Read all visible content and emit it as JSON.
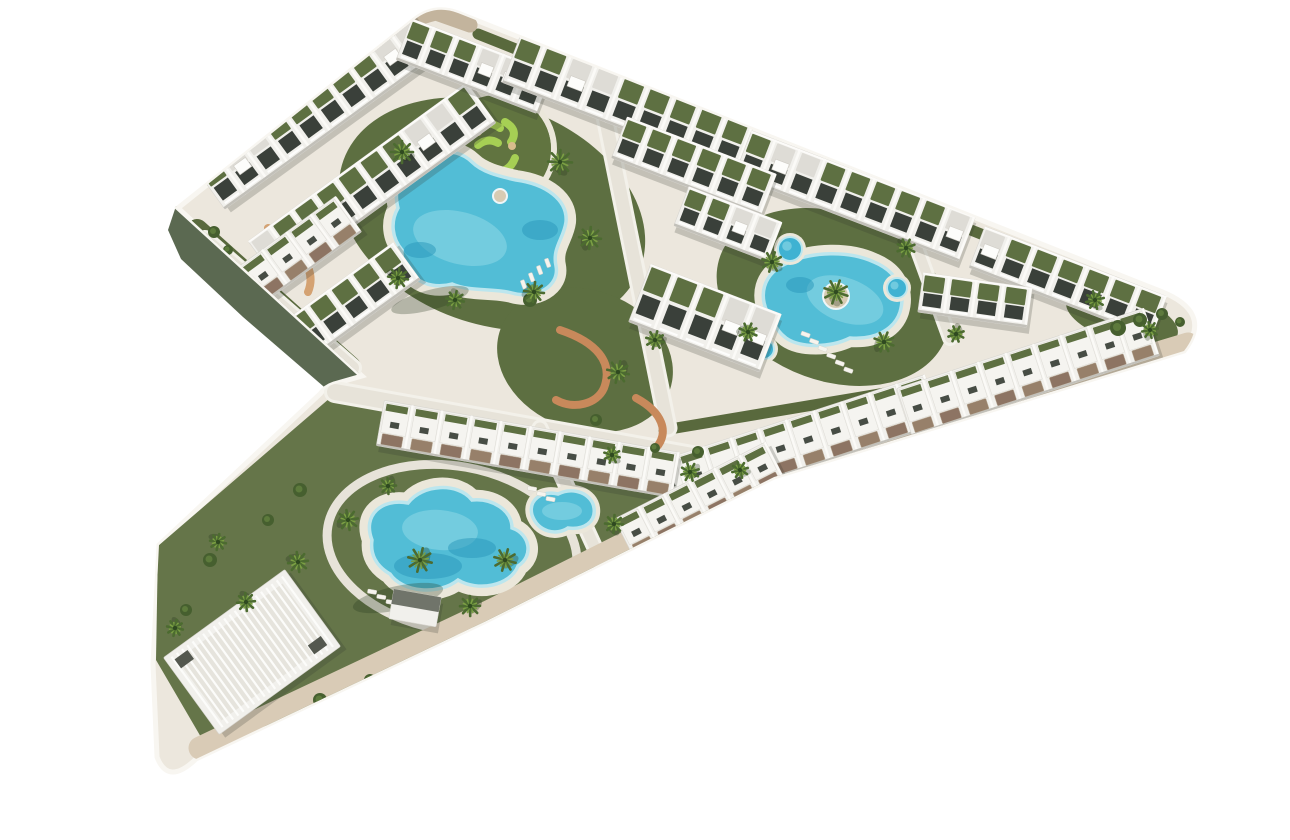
{
  "meta": {
    "title": "Aerial 3D architectural rendering of a chevron-shaped residential resort complex with white apartment rows, green roof gardens, three freeform swimming pools, spa circles and palm trees on a white background"
  },
  "palette": {
    "background": "#ffffff",
    "platform": "#ece7dd",
    "platform_rim": "#f8f6f1",
    "platform_side_dark": "#5b6951",
    "road_beige": "#d9cbb6",
    "road_tan": "#c3b49d",
    "road_light": "#e7e3d9",
    "road_casing": "#f3f1ea",
    "lawn": "#5d6f41",
    "lawn_light": "#657549",
    "lawn_edge": "#59693d",
    "minigolf_green": "#617440",
    "minigolf_lime": "#a6cf54",
    "court_green": "#3f5c31",
    "court_line": "#c9d2bf",
    "pool_water": "#52bdd6",
    "pool_light": "#86d4e4",
    "pool_deep": "#2796ba",
    "pool_edge": "#bce6ee",
    "pool_deck": "#ebe7da",
    "spa_water": "#3fb2d2",
    "building_white": "#f1f0ec",
    "building_shadow": "#c2c0b9",
    "window_dark": "#3a403a",
    "roof_green": "#5e7042",
    "patio_brown": "#97806a",
    "patio_brown2": "#8d7463",
    "path_terracotta": "#c8895b",
    "path_sand": "#d4a272",
    "palm_dark": "#4c6b30",
    "palm_light": "#7ba043",
    "bush": "#465f2f",
    "island_sand": "#d7cbb3"
  },
  "scene": {
    "platform_path": "M 178 208 L 414 20 Q 434 4 458 13 L 1160 291 Q 1214 312 1184 351 L 774 477 L 486 621 L 196 759 Q 168 786 157 757 L 153 664 L 159 545 L 320 394 Q 325 387 334 384 L 362 376 Z",
    "side_path": "M 176 206 L 362 374 L 345 405 L 243 317 L 181 259 L 168 230 Z",
    "tan_band_path": "M 362 52 Q 398 22 436 13 L 470 25",
    "beige_band_path": "M 1188 344 L 776 468 L 488 612 L 200 748",
    "edge_lawns": [
      [
        197,
        230,
        350,
        367,
        22
      ],
      [
        240,
        178,
        414,
        36,
        13
      ],
      [
        478,
        34,
        1152,
        302,
        11
      ],
      [
        664,
        430,
        1178,
        344,
        11
      ],
      [
        354,
        390,
        768,
        468,
        10
      ]
    ],
    "lawn_ellipses": [
      [
        492,
        214,
        158,
        110,
        20
      ],
      [
        833,
        297,
        120,
        84,
        20
      ],
      [
        1122,
        318,
        58,
        24,
        17
      ],
      [
        585,
        360,
        90,
        70,
        20
      ]
    ],
    "lawn_polygon": "M 330 398 L 700 462 L 770 476 L 560 638 L 205 744 L 156 660 L 158 546 Z",
    "roads": [
      [
        205,
        240,
        352,
        368,
        14
      ],
      [
        335,
        392,
        815,
        478,
        16
      ],
      [
        601,
        97,
        668,
        428,
        13
      ],
      [
        893,
        182,
        950,
        338,
        10
      ],
      [
        540,
        428,
        612,
        585,
        11
      ],
      [
        228,
        182,
        420,
        29,
        11
      ]
    ],
    "road_ring": [
      452,
      548,
      126,
      82,
      10,
      9
    ],
    "terracotta_paths": [
      "M 560 330 C 596 342 614 362 604 388 C 597 404 574 410 556 400",
      "M 636 398 C 662 412 670 432 656 448",
      "M 268 228 C 298 248 318 268 308 292"
    ],
    "minigolf": {
      "cx": 497,
      "cy": 149,
      "r": 54,
      "ring_r": 57,
      "squiggles": [
        "M 468 128 q 18 -10 32 0",
        "M 505 122 q 14 8 6 20",
        "M 515 158 q -6 16 -24 14",
        "M 482 170 q -16 -2 -18 -18",
        "M 478 145 q 10 -8 20 -2"
      ],
      "sand": [
        [
          478,
          132
        ],
        [
          512,
          146
        ],
        [
          489,
          166
        ]
      ]
    },
    "court": {
      "cx": 436,
      "cy": 206,
      "w": 82,
      "h": 48,
      "rot": 24
    },
    "pools": [
      {
        "name": "pool-lagoon",
        "deck": 20,
        "d": "M 405 175 C 420 148 455 145 472 162 C 482 172 498 176 516 180 C 546 184 568 200 566 222 C 564 238 552 248 556 266 C 560 286 536 300 512 293 C 494 288 470 292 452 284 C 424 292 400 272 402 250 C 392 238 390 222 398 208 C 394 192 398 184 405 175 Z",
        "light": [
          460,
          238,
          48,
          26,
          15
        ],
        "deep": [
          [
            540,
            230,
            18,
            10
          ],
          [
            420,
            250,
            16,
            8
          ]
        ]
      },
      {
        "name": "pool-oval-island",
        "deck": 18,
        "d": "M 772 320 C 756 298 762 272 790 262 C 812 252 848 250 874 262 C 898 272 906 292 900 312 C 894 330 874 340 850 338 C 830 348 800 348 786 338 C 778 332 776 327 772 320 Z",
        "light": [
          845,
          300,
          40,
          22,
          20
        ],
        "deep": [
          [
            800,
            285,
            14,
            8
          ]
        ]
      },
      {
        "name": "pool-lower",
        "deck": 20,
        "d": "M 372 540 C 362 515 382 498 408 503 C 422 484 458 482 472 500 C 492 498 512 510 512 528 C 530 534 534 556 518 566 C 510 586 478 592 458 580 C 438 596 402 592 390 574 C 376 566 370 554 372 540 Z",
        "light": [
          440,
          530,
          38,
          20,
          5
        ],
        "deep": [
          [
            428,
            566,
            34,
            13
          ],
          [
            472,
            548,
            24,
            10
          ]
        ]
      },
      {
        "name": "pool-kidney",
        "deck": 12,
        "d": "M 532 515 C 528 500 542 490 558 494 C 574 486 592 494 594 508 C 596 522 584 530 568 528 C 556 536 538 532 532 515 Z",
        "light": [
          562,
          511,
          20,
          9,
          0
        ],
        "deep": []
      }
    ],
    "islands": [
      [
        836,
        296,
        13
      ],
      [
        500,
        196,
        7
      ]
    ],
    "spas": [
      [
        790,
        249,
        12
      ],
      [
        897,
        288,
        10
      ],
      [
        764,
        349,
        10
      ]
    ],
    "pool_shadows": [
      [
        398,
        598,
        46,
        12,
        -12
      ],
      [
        430,
        300,
        40,
        10,
        -15
      ]
    ],
    "loungers": [
      {
        "x": 802,
        "y": 331,
        "rot": 20,
        "n": 6,
        "dx": 10.5,
        "dy": 3.8
      },
      {
        "x": 548,
        "y": 258,
        "rot": 70,
        "n": 4,
        "dx": 4,
        "dy": 10
      },
      {
        "x": 368,
        "y": 589,
        "rot": 10,
        "n": 4,
        "dx": 10,
        "dy": 3.5
      },
      {
        "x": 528,
        "y": 486,
        "rot": 10,
        "n": 3,
        "dx": 10,
        "dy": 3.5
      }
    ],
    "blocks": [
      [
        318,
        112,
        265,
        48,
        -36,
        "row"
      ],
      [
        372,
        182,
        270,
        50,
        -36,
        "row"
      ],
      [
        342,
        308,
        160,
        46,
        -36,
        "row"
      ],
      [
        288,
        258,
        150,
        44,
        -36,
        "town"
      ],
      [
        474,
        66,
        150,
        44,
        21,
        "row"
      ],
      [
        628,
        104,
        250,
        50,
        21,
        "row"
      ],
      [
        855,
        196,
        240,
        48,
        21,
        "row"
      ],
      [
        1068,
        282,
        195,
        44,
        21,
        "row"
      ],
      [
        694,
        166,
        160,
        44,
        21,
        "row"
      ],
      [
        975,
        300,
        110,
        40,
        8,
        "row"
      ],
      [
        705,
        318,
        140,
        62,
        21,
        "row"
      ],
      [
        728,
        224,
        100,
        42,
        21,
        "row"
      ],
      [
        795,
        444,
        290,
        52,
        -18,
        "town"
      ],
      [
        1028,
        372,
        260,
        50,
        -18,
        "town"
      ],
      [
        528,
        449,
        300,
        46,
        10,
        "town"
      ],
      [
        700,
        500,
        170,
        44,
        -27,
        "town"
      ],
      [
        252,
        652,
        150,
        95,
        -36,
        "club"
      ],
      [
        415,
        608,
        48,
        30,
        10,
        "pav"
      ]
    ],
    "bushes": [
      [
        1118,
        328,
        8
      ],
      [
        1140,
        320,
        7
      ],
      [
        1162,
        314,
        6
      ],
      [
        1180,
        322,
        5
      ],
      [
        698,
        452,
        6
      ],
      [
        655,
        448,
        5
      ],
      [
        214,
        232,
        6
      ],
      [
        228,
        250,
        5
      ],
      [
        596,
        420,
        6
      ],
      [
        530,
        300,
        7
      ],
      [
        300,
        490,
        7
      ],
      [
        268,
        520,
        6
      ],
      [
        210,
        560,
        7
      ],
      [
        186,
        610,
        6
      ],
      [
        320,
        700,
        7
      ],
      [
        370,
        680,
        6
      ],
      [
        300,
        330,
        6
      ],
      [
        585,
        640,
        7
      ],
      [
        620,
        615,
        6
      ]
    ],
    "palms": [
      [
        402,
        152,
        11
      ],
      [
        560,
        162,
        12
      ],
      [
        590,
        238,
        11
      ],
      [
        534,
        292,
        10
      ],
      [
        398,
        278,
        10
      ],
      [
        455,
        300,
        9
      ],
      [
        618,
        372,
        11
      ],
      [
        655,
        340,
        9
      ],
      [
        772,
        262,
        10
      ],
      [
        836,
        292,
        12
      ],
      [
        884,
        342,
        10
      ],
      [
        748,
        332,
        9
      ],
      [
        906,
        248,
        9
      ],
      [
        956,
        334,
        8
      ],
      [
        690,
        472,
        9
      ],
      [
        740,
        470,
        8
      ],
      [
        1095,
        300,
        9
      ],
      [
        1150,
        330,
        8
      ],
      [
        348,
        520,
        10
      ],
      [
        298,
        562,
        10
      ],
      [
        246,
        602,
        9
      ],
      [
        388,
        486,
        8
      ],
      [
        470,
        606,
        10
      ],
      [
        562,
        600,
        10
      ],
      [
        614,
        524,
        9
      ],
      [
        505,
        644,
        9
      ],
      [
        640,
        588,
        8
      ],
      [
        218,
        542,
        8
      ],
      [
        175,
        628,
        8
      ],
      [
        420,
        560,
        12
      ],
      [
        505,
        560,
        11
      ],
      [
        612,
        455,
        8
      ]
    ]
  }
}
